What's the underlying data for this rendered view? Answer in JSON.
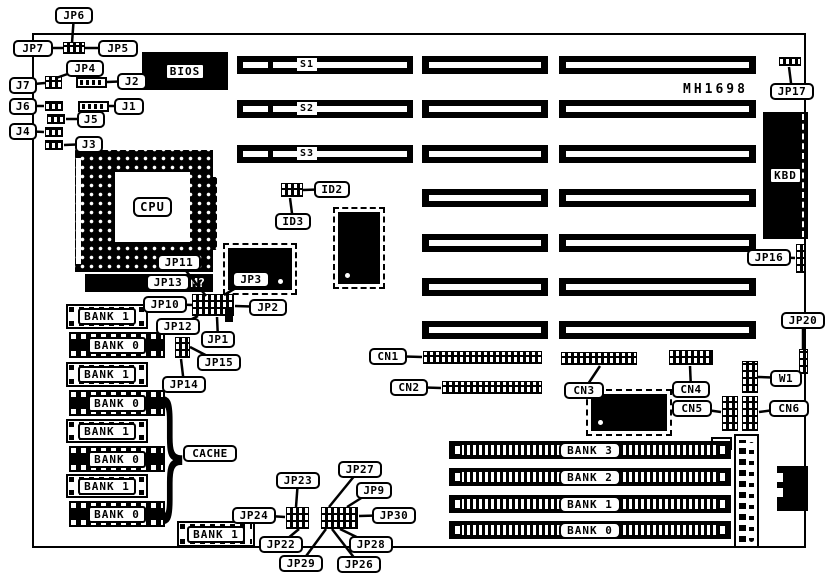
{
  "board": {
    "id_text": "MH1698",
    "cpu_label": "CPU",
    "bios_label": "BIOS",
    "kbd_label": "KBD",
    "vrm_text": "M?",
    "brace_glyph": "}"
  },
  "isa_slots": {
    "rows": [
      {
        "y": 56,
        "label": "S1",
        "has_left": true
      },
      {
        "y": 100,
        "label": "S2",
        "has_left": true
      },
      {
        "y": 145,
        "label": "S3",
        "has_left": true
      },
      {
        "y": 189,
        "label": "",
        "has_left": false
      },
      {
        "y": 234,
        "label": "",
        "has_left": false
      },
      {
        "y": 278,
        "label": "",
        "has_left": false
      },
      {
        "y": 321,
        "label": "",
        "has_left": false
      }
    ]
  },
  "cache_chips": [
    {
      "label": "BANK 1",
      "x": 66,
      "y": 304,
      "w": 82,
      "h": 25,
      "style": "light"
    },
    {
      "label": "BANK 0",
      "x": 69,
      "y": 332,
      "w": 96,
      "h": 26,
      "style": "dark"
    },
    {
      "label": "BANK 1",
      "x": 66,
      "y": 362,
      "w": 82,
      "h": 25,
      "style": "light"
    },
    {
      "label": "BANK 0",
      "x": 69,
      "y": 390,
      "w": 96,
      "h": 26,
      "style": "dark"
    },
    {
      "label": "BANK 1",
      "x": 66,
      "y": 419,
      "w": 82,
      "h": 24,
      "style": "light"
    },
    {
      "label": "BANK 0",
      "x": 69,
      "y": 446,
      "w": 96,
      "h": 26,
      "style": "dark"
    },
    {
      "label": "BANK 1",
      "x": 66,
      "y": 474,
      "w": 82,
      "h": 24,
      "style": "light"
    },
    {
      "label": "BANK 0",
      "x": 69,
      "y": 501,
      "w": 96,
      "h": 26,
      "style": "dark"
    },
    {
      "label": "BANK 1",
      "x": 177,
      "y": 521,
      "w": 78,
      "h": 26,
      "style": "light"
    }
  ],
  "simm_slots": [
    {
      "label": "BANK 3",
      "y": 441
    },
    {
      "label": "BANK 2",
      "y": 468
    },
    {
      "label": "BANK 1",
      "y": 495
    },
    {
      "label": "BANK 0",
      "y": 521
    }
  ],
  "headers": [
    {
      "name": "jp5-6-7-jumper",
      "x": 63,
      "y": 42,
      "w": 22,
      "h": 12,
      "type": "dark"
    },
    {
      "name": "j7-jumper",
      "x": 45,
      "y": 76,
      "w": 17,
      "h": 13,
      "type": "dark"
    },
    {
      "name": "j2-header",
      "x": 76,
      "y": 77,
      "w": 31,
      "h": 11,
      "type": "light"
    },
    {
      "name": "j6-jumper",
      "x": 45,
      "y": 101,
      "w": 18,
      "h": 10,
      "type": "dark"
    },
    {
      "name": "j1-header",
      "x": 78,
      "y": 101,
      "w": 31,
      "h": 11,
      "type": "light"
    },
    {
      "name": "j5-jumper",
      "x": 47,
      "y": 114,
      "w": 18,
      "h": 10,
      "type": "dark"
    },
    {
      "name": "j4-jumper",
      "x": 45,
      "y": 127,
      "w": 18,
      "h": 10,
      "type": "dark"
    },
    {
      "name": "j3-jumper",
      "x": 45,
      "y": 140,
      "w": 18,
      "h": 10,
      "type": "dark"
    },
    {
      "name": "id2-jumper",
      "x": 281,
      "y": 183,
      "w": 22,
      "h": 14,
      "type": "dark"
    },
    {
      "name": "jp1-2-10-header",
      "x": 192,
      "y": 294,
      "w": 42,
      "h": 22,
      "type": "dark"
    },
    {
      "name": "jp1-stub",
      "x": 225,
      "y": 308,
      "w": 8,
      "h": 14,
      "type": "solid"
    },
    {
      "name": "jp14-15-jumper",
      "x": 175,
      "y": 337,
      "w": 15,
      "h": 21,
      "type": "dark"
    },
    {
      "name": "cn1-header",
      "x": 423,
      "y": 351,
      "w": 119,
      "h": 13,
      "type": "dark"
    },
    {
      "name": "cn2-header",
      "x": 442,
      "y": 381,
      "w": 100,
      "h": 13,
      "type": "dark"
    },
    {
      "name": "cn3-header",
      "x": 561,
      "y": 352,
      "w": 76,
      "h": 13,
      "type": "dark"
    },
    {
      "name": "cn4-header",
      "x": 669,
      "y": 350,
      "w": 44,
      "h": 15,
      "type": "dark"
    },
    {
      "name": "w1-header",
      "x": 742,
      "y": 361,
      "w": 16,
      "h": 32,
      "type": "dark"
    },
    {
      "name": "cn5-header",
      "x": 722,
      "y": 396,
      "w": 16,
      "h": 35,
      "type": "dark"
    },
    {
      "name": "cn6-header",
      "x": 742,
      "y": 396,
      "w": 16,
      "h": 35,
      "type": "dark"
    },
    {
      "name": "jp17-jumper",
      "x": 779,
      "y": 57,
      "w": 22,
      "h": 9,
      "type": "dark"
    },
    {
      "name": "jp16-connector",
      "x": 796,
      "y": 244,
      "w": 9,
      "h": 29,
      "type": "dark"
    },
    {
      "name": "jp20-jumper",
      "x": 799,
      "y": 349,
      "w": 9,
      "h": 25,
      "type": "dark"
    },
    {
      "name": "jp22-23-24-29-jumper-block",
      "x": 286,
      "y": 507,
      "w": 23,
      "h": 22,
      "type": "dark"
    },
    {
      "name": "jp9-26-27-28-30-jumper-block",
      "x": 321,
      "y": 507,
      "w": 37,
      "h": 22,
      "type": "dark"
    }
  ],
  "chips": [
    {
      "name": "chip-near-bios",
      "x": 338,
      "y": 212,
      "w": 42,
      "h": 72,
      "dot": "bl"
    },
    {
      "name": "chip-near-cpu",
      "x": 228,
      "y": 248,
      "w": 64,
      "h": 42,
      "dot": "br"
    },
    {
      "name": "chip-near-cn3",
      "x": 591,
      "y": 394,
      "w": 76,
      "h": 37,
      "dot": "bl"
    }
  ],
  "callouts": [
    {
      "label": "JP6",
      "x": 55,
      "y": 7,
      "w": 38,
      "tx": 72,
      "ty": 43
    },
    {
      "label": "JP7",
      "x": 13,
      "y": 40,
      "w": 40,
      "tx": 63,
      "ty": 48
    },
    {
      "label": "JP5",
      "x": 98,
      "y": 40,
      "w": 40,
      "tx": 85,
      "ty": 48
    },
    {
      "label": "JP4",
      "x": 66,
      "y": 60,
      "w": 38,
      "tx": 56,
      "ty": 78
    },
    {
      "label": "J7",
      "x": 9,
      "y": 77,
      "w": 28,
      "tx": 45,
      "ty": 83
    },
    {
      "label": "J2",
      "x": 117,
      "y": 73,
      "w": 30,
      "tx": 107,
      "ty": 82
    },
    {
      "label": "J6",
      "x": 9,
      "y": 98,
      "w": 28,
      "tx": 44,
      "ty": 106
    },
    {
      "label": "J1",
      "x": 114,
      "y": 98,
      "w": 30,
      "tx": 109,
      "ty": 106
    },
    {
      "label": "J5",
      "x": 77,
      "y": 111,
      "w": 28,
      "tx": 66,
      "ty": 119
    },
    {
      "label": "J4",
      "x": 9,
      "y": 123,
      "w": 28,
      "tx": 44,
      "ty": 132
    },
    {
      "label": "J3",
      "x": 75,
      "y": 136,
      "w": 28,
      "tx": 64,
      "ty": 145
    },
    {
      "label": "ID2",
      "x": 314,
      "y": 181,
      "w": 36,
      "tx": 303,
      "ty": 190
    },
    {
      "label": "ID3",
      "x": 275,
      "y": 213,
      "w": 36,
      "tx": 290,
      "ty": 198
    },
    {
      "label": "JP11",
      "x": 157,
      "y": 254,
      "w": 44,
      "tx": 206,
      "ty": 296
    },
    {
      "label": "JP13",
      "x": 146,
      "y": 274,
      "w": 44,
      "tx": 138,
      "ty": 284
    },
    {
      "label": "JP3",
      "x": 232,
      "y": 271,
      "w": 38,
      "tx": 224,
      "ty": 295
    },
    {
      "label": "JP10",
      "x": 143,
      "y": 296,
      "w": 44,
      "tx": 192,
      "ty": 305
    },
    {
      "label": "JP2",
      "x": 249,
      "y": 299,
      "w": 38,
      "tx": 235,
      "ty": 306
    },
    {
      "label": "JP12",
      "x": 156,
      "y": 318,
      "w": 44,
      "tx": 198,
      "ty": 316
    },
    {
      "label": "JP1",
      "x": 201,
      "y": 331,
      "w": 34,
      "tx": 217,
      "ty": 317
    },
    {
      "label": "JP15",
      "x": 197,
      "y": 354,
      "w": 44,
      "tx": 190,
      "ty": 347
    },
    {
      "label": "JP14",
      "x": 162,
      "y": 376,
      "w": 44,
      "tx": 181,
      "ty": 359
    },
    {
      "label": "CN1",
      "x": 369,
      "y": 348,
      "w": 38,
      "tx": 422,
      "ty": 357
    },
    {
      "label": "CN2",
      "x": 390,
      "y": 379,
      "w": 38,
      "tx": 441,
      "ty": 388
    },
    {
      "label": "CN3",
      "x": 564,
      "y": 382,
      "w": 40,
      "tx": 600,
      "ty": 366
    },
    {
      "label": "CN4",
      "x": 672,
      "y": 381,
      "w": 38,
      "tx": 690,
      "ty": 366
    },
    {
      "label": "CN5",
      "x": 672,
      "y": 400,
      "w": 40,
      "tx": 721,
      "ty": 412
    },
    {
      "label": "CN6",
      "x": 769,
      "y": 400,
      "w": 40,
      "tx": 759,
      "ty": 412
    },
    {
      "label": "W1",
      "x": 770,
      "y": 370,
      "w": 32,
      "tx": 758,
      "ty": 377
    },
    {
      "label": "JP20",
      "x": 781,
      "y": 312,
      "w": 44,
      "tx": 803,
      "ty": 350
    },
    {
      "label": "JP17",
      "x": 770,
      "y": 83,
      "w": 44,
      "tx": 789,
      "ty": 67
    },
    {
      "label": "JP16",
      "x": 747,
      "y": 249,
      "w": 44,
      "tx": 795,
      "ty": 258
    },
    {
      "label": "JP23",
      "x": 276,
      "y": 472,
      "w": 44,
      "tx": 296,
      "ty": 507
    },
    {
      "label": "JP24",
      "x": 232,
      "y": 507,
      "w": 44,
      "tx": 285,
      "ty": 517
    },
    {
      "label": "JP22",
      "x": 259,
      "y": 536,
      "w": 44,
      "tx": 299,
      "ty": 529
    },
    {
      "label": "JP29",
      "x": 279,
      "y": 555,
      "w": 44,
      "tx": 326,
      "ty": 529
    },
    {
      "label": "JP27",
      "x": 338,
      "y": 461,
      "w": 44,
      "tx": 329,
      "ty": 507
    },
    {
      "label": "JP9",
      "x": 356,
      "y": 482,
      "w": 36,
      "tx": 347,
      "ty": 507
    },
    {
      "label": "JP30",
      "x": 372,
      "y": 507,
      "w": 44,
      "tx": 359,
      "ty": 516
    },
    {
      "label": "JP28",
      "x": 349,
      "y": 536,
      "w": 44,
      "tx": 340,
      "ty": 529
    },
    {
      "label": "JP26",
      "x": 337,
      "y": 556,
      "w": 44,
      "tx": 332,
      "ty": 529
    },
    {
      "label": "CACHE",
      "x": 183,
      "y": 445,
      "w": 54
    }
  ]
}
